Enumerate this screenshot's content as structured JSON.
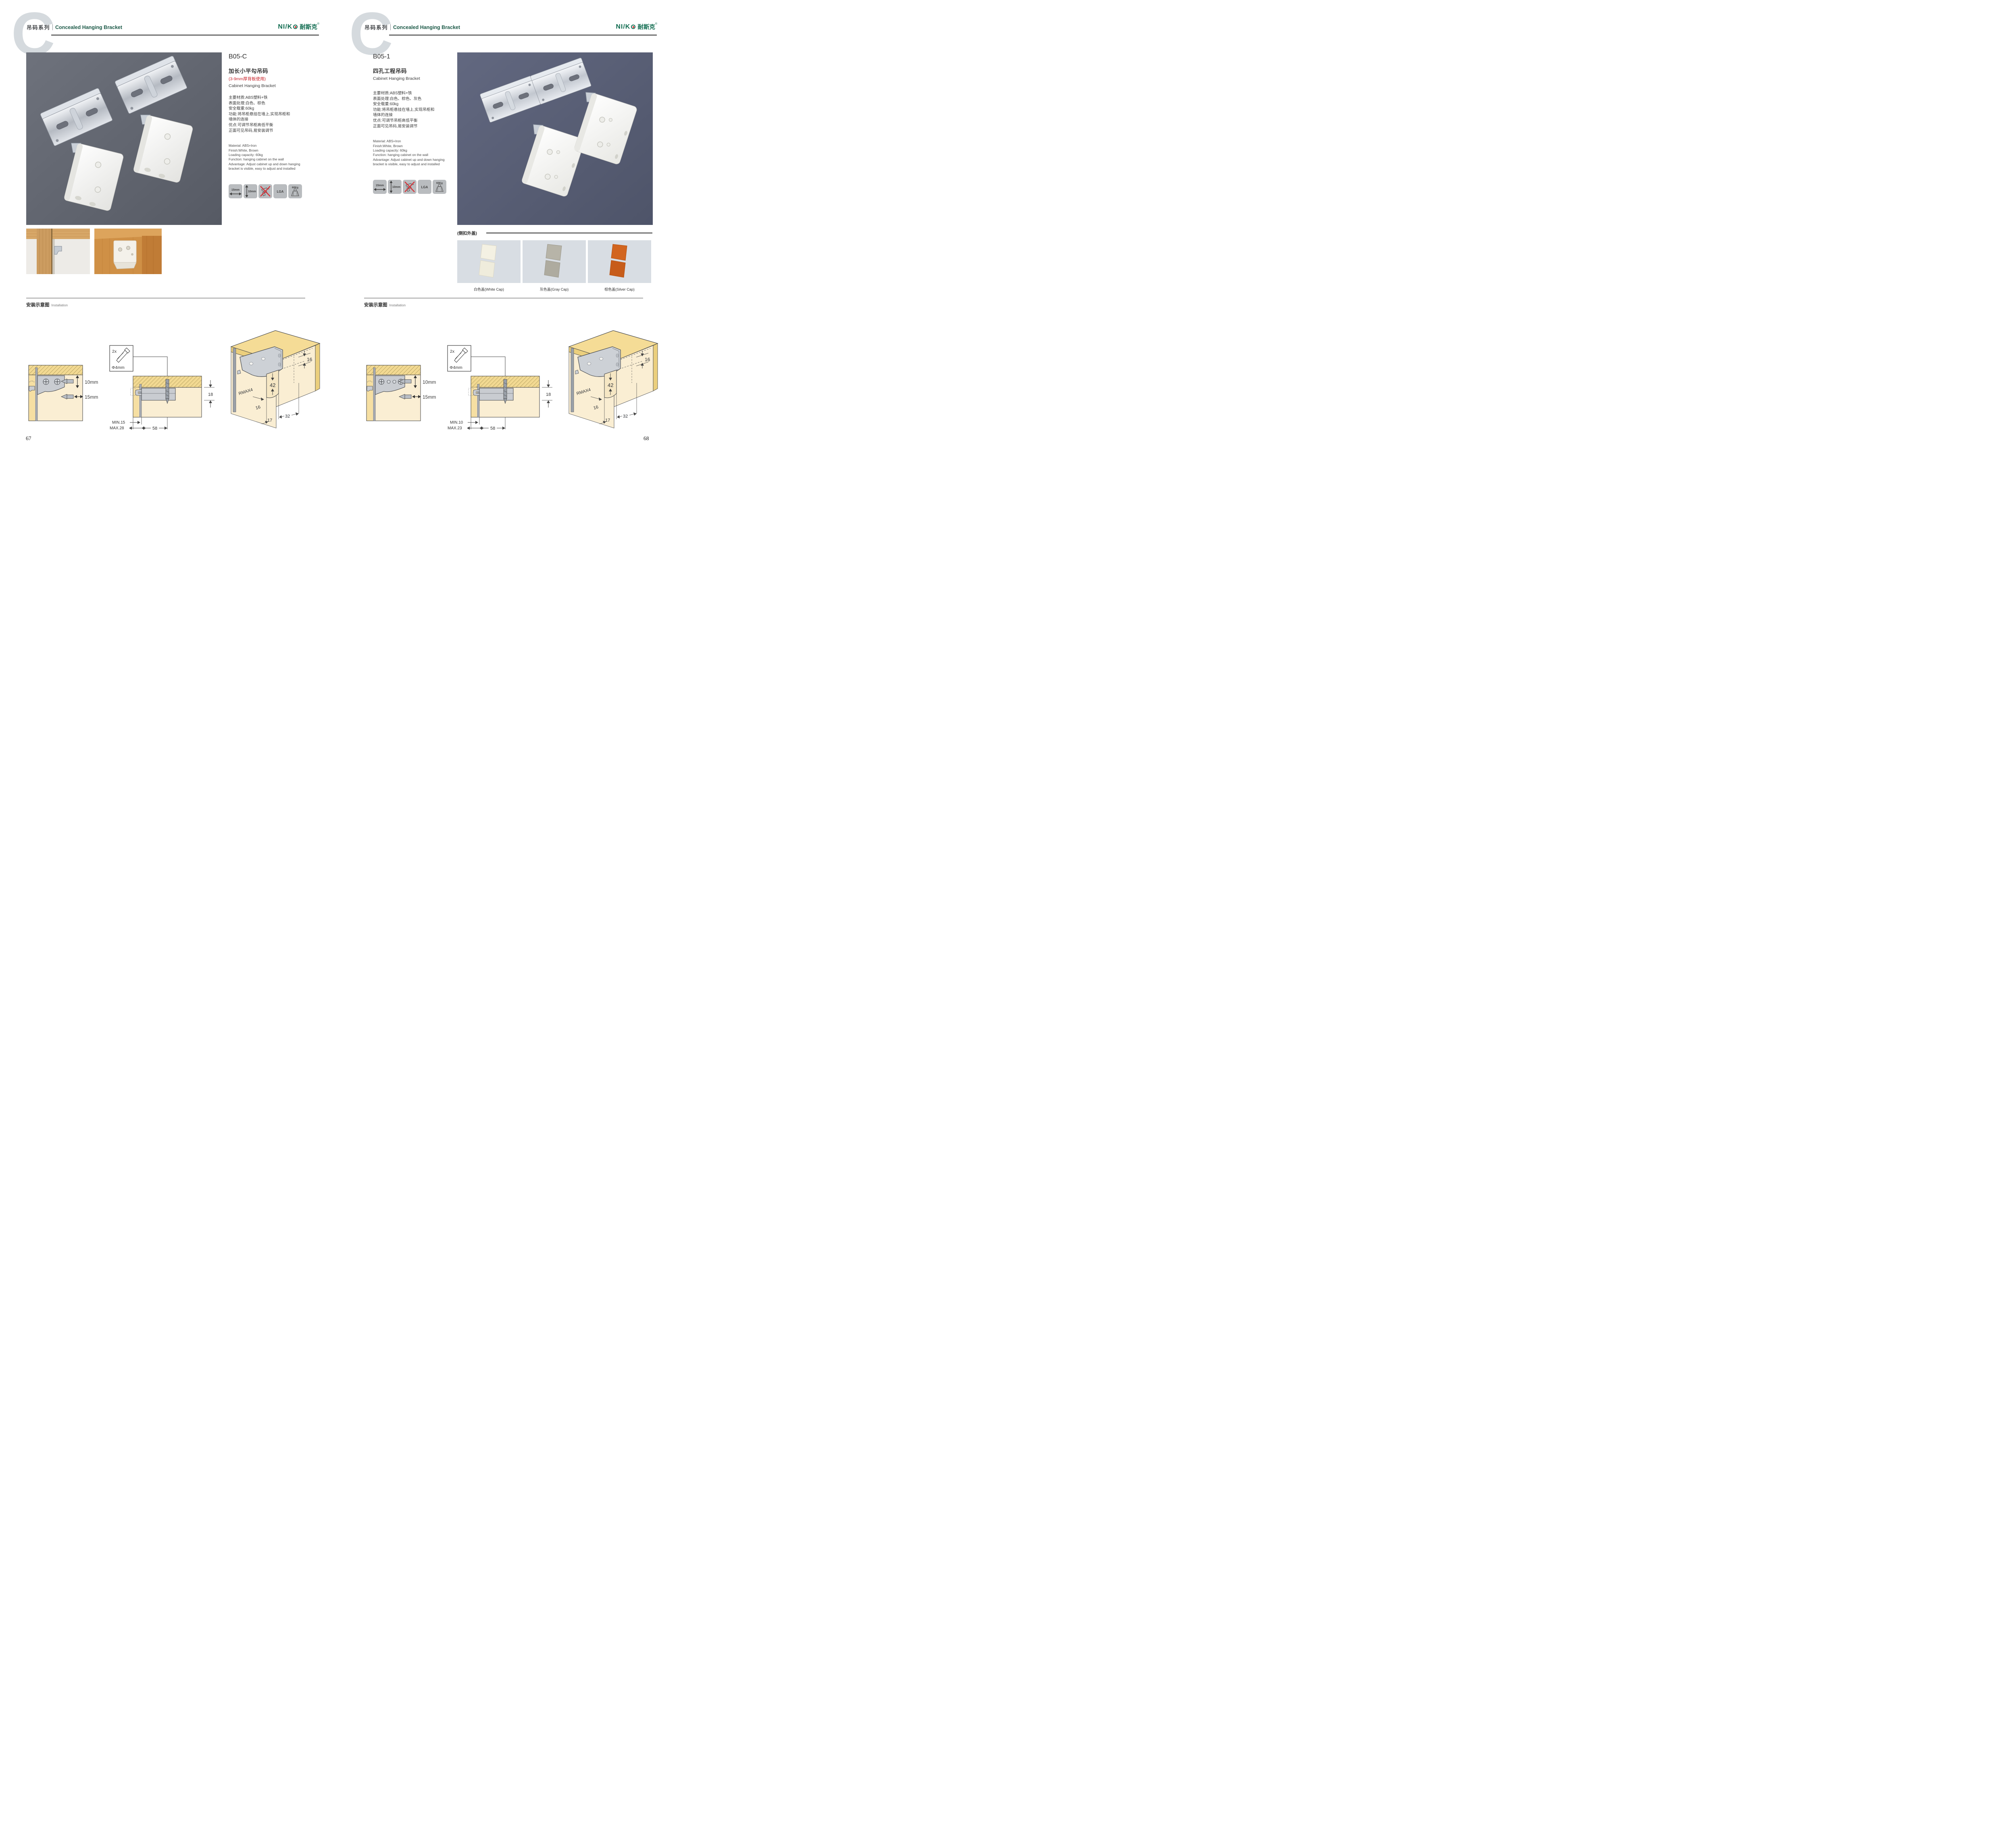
{
  "header": {
    "letter": "C",
    "series_cn": "吊码系列",
    "series_en": "Concealed Hanging Bracket"
  },
  "brand": {
    "latin": "NI/K",
    "cn": "耐斯克",
    "reg": "®"
  },
  "badges": {
    "b1": "15mm",
    "b2": "10mm",
    "b4": "LGA",
    "b5": "60Kg"
  },
  "install": {
    "title_cn": "安装示意图",
    "title_en": "Installation"
  },
  "pages": [
    {
      "number": "67",
      "product": {
        "code": "B05-C",
        "name_cn": "加长小平勾吊码",
        "note": "(3-9mm厚背板使用)",
        "name_en": "Cabinet Hanging Bracket",
        "specs_cn": [
          "主要材质:ABS塑料+铁",
          "表面处理:白色、棕色",
          "安全载重:60kg",
          "功能:将吊柜悬挂在墙上,实现吊柜和",
          "墙体的连接",
          "优点:可调节吊柜高低平衡",
          "正面可见吊码,易安装调节"
        ],
        "specs_en": [
          "Material: ABS+Iron",
          "Finish:White, Brown",
          "Loading capacity: 60kg",
          "Function: hanging cabinet on the wall",
          "Advantage: Adjust cabinet up and down hanging",
          "bracket is visible, easy to adjust and installed"
        ]
      },
      "diagram": {
        "d10": "10mm",
        "d15": "15mm",
        "screw_qty": "2x",
        "screw_dia": "Φ4mm",
        "h18": "18",
        "min": "MIN.15",
        "max": "MAX.28",
        "len58": "58",
        "a16": "16",
        "a42": "42",
        "rmax": "RMAX4",
        "b16": "16",
        "c17": "17",
        "d32": "32"
      }
    },
    {
      "number": "68",
      "product": {
        "code": "B05-1",
        "name_cn": "四孔工程吊码",
        "name_en": "Cabinet Hanging Bracket",
        "specs_cn": [
          "主要材质:ABS塑料+铁",
          "表面处理:白色、棕色、灰色",
          "安全载重:60kg",
          "功能:将吊柜悬挂在墙上,实现吊柜和",
          "墙体的连接",
          "优点:可调节吊柜高低平衡",
          "正面可见吊码,易安装调节"
        ],
        "specs_en": [
          "Material: ABS+Iron",
          "Finish:White, Brown",
          "Loading capacity: 60kg",
          "Function: hanging cabinet on the wall",
          "Advantage: Adjust cabinet up and down hanging",
          "bracket is visible, easy to adjust and installed"
        ]
      },
      "caps": {
        "label": "(侧扣外盖)",
        "captions": [
          "白色盖(White Cap)",
          "灰色盖(Gray Cap)",
          "棕色盖(Silver Cap)"
        ]
      },
      "diagram": {
        "d10": "10mm",
        "d15": "15mm",
        "screw_qty": "2x",
        "screw_dia": "Φ4mm",
        "h18": "18",
        "min": "MIN.10",
        "max": "MAX.23",
        "len58": "58",
        "a16": "16",
        "a42": "42",
        "rmax": "RMAX4",
        "b16": "16",
        "c17": "17",
        "d32": "32"
      }
    }
  ]
}
